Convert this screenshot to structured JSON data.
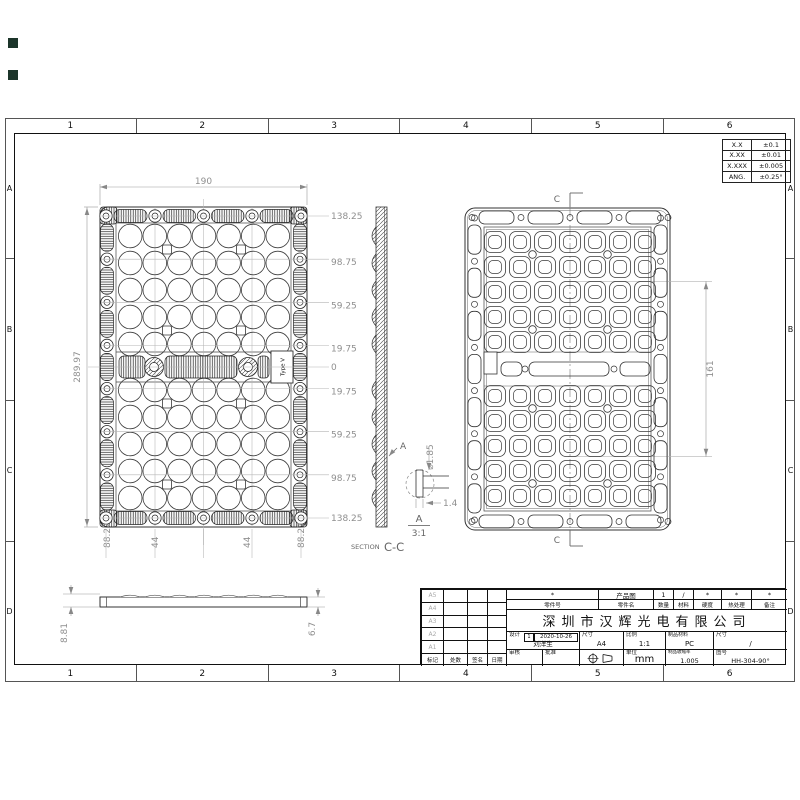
{
  "sheet": {
    "grid_columns": [
      "1",
      "2",
      "3",
      "4",
      "5",
      "6"
    ],
    "grid_rows": [
      "A",
      "B",
      "C",
      "D"
    ]
  },
  "tolerance_table": {
    "rows": [
      [
        "X.X",
        "±0.1"
      ],
      [
        "X.XX",
        "±0.01"
      ],
      [
        "X.XXX",
        "±0.005"
      ],
      [
        "ANG.",
        "±0.25°"
      ]
    ]
  },
  "front_view": {
    "width_dim": "190",
    "height_dim": "289.97",
    "right_dims": [
      "138.25",
      "98.75",
      "59.25",
      "19.75",
      "0",
      "19.75",
      "59.25",
      "98.75",
      "138.25"
    ],
    "bottom_dims": [
      "88.27",
      "44",
      "44",
      "88.27"
    ],
    "lens_type_label": "Type V"
  },
  "section_view": {
    "label_prefix": "SECTION",
    "label": "C-C",
    "cut_label": "A"
  },
  "detail_view": {
    "name": "A",
    "scale": "3:1",
    "diameter_dim": "⌀1.85",
    "width_dim": "1.4"
  },
  "back_view": {
    "section_label": "C",
    "height_dim": "161"
  },
  "profile_view": {
    "left_dim": "8.81",
    "right_dim": "6.7"
  },
  "title_block": {
    "part_no_value": "*",
    "part_no_label": "零件号",
    "part_name_value": "产品图",
    "part_name_label": "零件名",
    "qty_value": "1",
    "qty_label": "数量",
    "material_value": "/",
    "material_label": "材料",
    "hardness_value": "*",
    "hardness_label": "硬度",
    "treatment_value": "*",
    "treatment_label": "热处理",
    "remark_value": "*",
    "remark_label": "备注",
    "company": "深圳市汉辉光电有限公司",
    "design_label": "设计",
    "design_rev": "1",
    "design_date": "2020-10-26",
    "designer": "刘洋生",
    "size_label": "尺寸",
    "size_value": "A4",
    "scale_label": "比例",
    "scale_value": "1:1",
    "prod_material_label": "制品材料",
    "prod_material_value": "PC",
    "dim_label": "尺寸",
    "dim_value": "/",
    "check_label": "审核",
    "approve_label": "批准",
    "unit_label": "单位",
    "unit_value": "mm",
    "shrinkage_label": "制品收缩率",
    "shrinkage_value": "1.005",
    "drawing_no_label": "图号",
    "drawing_no_value": "HH-304-90°",
    "revision_rows": [
      "A5",
      "A4",
      "A3",
      "A2",
      "A1"
    ],
    "revision_headers": [
      "标记",
      "处数",
      "签名",
      "日期"
    ]
  }
}
